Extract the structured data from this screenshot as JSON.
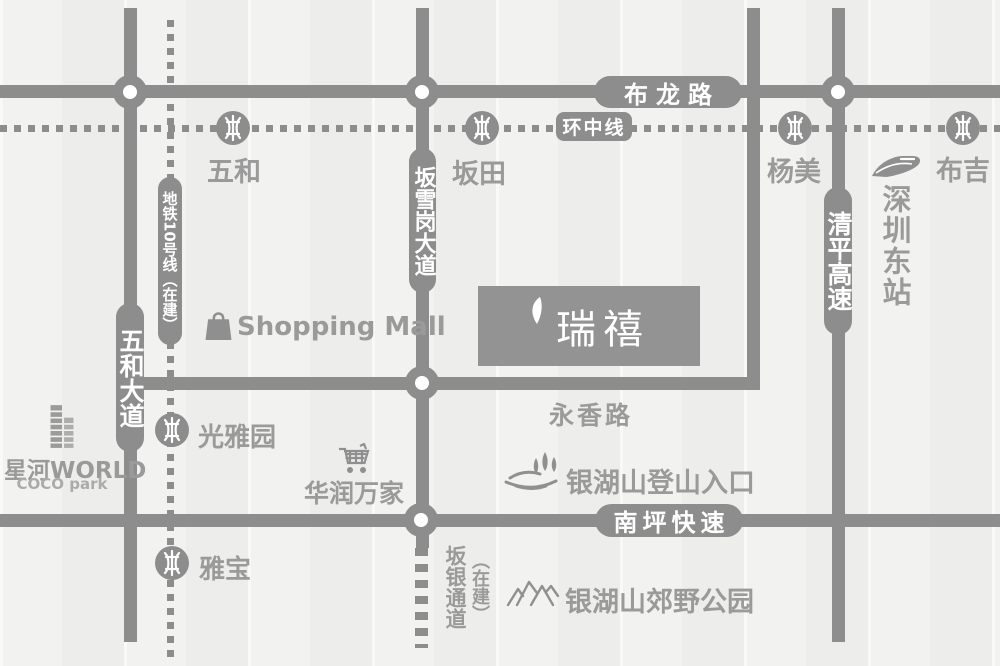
{
  "map": {
    "colors": {
      "bg": "#f2f2f0",
      "road": "#8d8d8d",
      "label": "#9a9a9a",
      "pill_text": "#ffffff",
      "project_box": "#939393"
    },
    "roads": {
      "bulong": "布龙路",
      "huanzhong": "环中线",
      "wuhe_avenue": "五和大道",
      "metro_line10": "地铁10号线（在建）",
      "banxuegang": "坂雪岗大道",
      "qingping": "清平高速",
      "yongxiang": "永香路",
      "nanping": "南坪快速",
      "banyin": "坂银通道",
      "banyin_status": "（在建）"
    },
    "stations": [
      {
        "name": "五和"
      },
      {
        "name": "坂田"
      },
      {
        "name": "杨美"
      },
      {
        "name": "布吉"
      },
      {
        "name": "光雅园"
      },
      {
        "name": "雅宝"
      }
    ],
    "landmarks": {
      "shopping_mall": "Shopping Mall",
      "project_name": "瑞禧",
      "xinghe_world": "星河WORLD",
      "coco_park": "COCO park",
      "huarun_vanguard": "华润万家",
      "hiking_entrance": "银湖山登山入口",
      "country_park": "银湖山郊野公园",
      "shenzhen_east_station": "深圳东站"
    }
  }
}
